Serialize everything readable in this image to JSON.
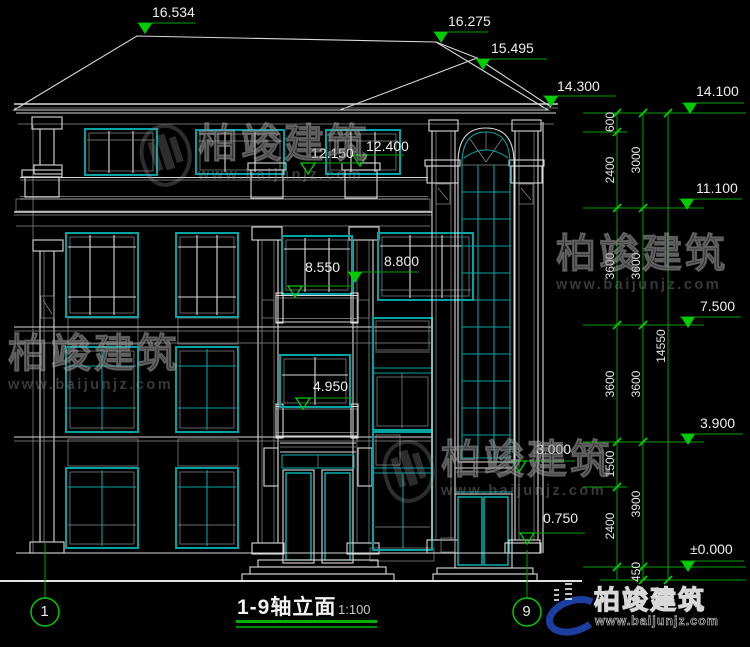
{
  "drawing_title": {
    "text": "1-9轴立面",
    "scale": "1:100"
  },
  "axes": {
    "start": "1",
    "end": "9"
  },
  "brand": {
    "name": "柏竣建筑",
    "website": "www.baijunjz.com"
  },
  "colors": {
    "dimension_green": "#00a000",
    "marker_green": "#00cc00",
    "window_teal": "#00a2a2",
    "baluster_cyan": "#00dcdc",
    "line_white": "#d9d9d9",
    "logo_blue": "#1d64d8",
    "logo_orange": "#f59e1d",
    "logo_swoosh": "#1c3e9e"
  },
  "elevation_markers": [
    {
      "value": "16.534",
      "x": 145,
      "y": 34,
      "len": 58,
      "tx": 152,
      "ty": 5,
      "solid": true
    },
    {
      "value": "16.275",
      "x": 441,
      "y": 43,
      "len": 55,
      "tx": 448,
      "ty": 14,
      "solid": true
    },
    {
      "value": "15.495",
      "x": 483,
      "y": 70,
      "len": 72,
      "tx": 491,
      "ty": 41,
      "solid": true
    },
    {
      "value": "14.300",
      "x": 551,
      "y": 107,
      "len": 73,
      "tx": 557,
      "ty": 79,
      "solid": true
    },
    {
      "value": "12.150",
      "x": 308,
      "y": 174,
      "len": 60,
      "tx": 311,
      "ty": 146,
      "solid": false
    },
    {
      "value": "12.400",
      "x": 360,
      "y": 166,
      "len": 52,
      "tx": 366,
      "ty": 139,
      "solid": false
    },
    {
      "value": "8.550",
      "x": 295,
      "y": 297,
      "len": 66,
      "tx": 305,
      "ty": 260,
      "solid": false
    },
    {
      "value": "8.800",
      "x": 355,
      "y": 283,
      "len": 72,
      "tx": 384,
      "ty": 254,
      "solid": true
    },
    {
      "value": "4.950",
      "x": 303,
      "y": 409,
      "len": 58,
      "tx": 313,
      "ty": 379,
      "solid": false
    },
    {
      "value": "3.000",
      "x": 519,
      "y": 472,
      "len": 64,
      "tx": 536,
      "ty": 442,
      "solid": false
    },
    {
      "value": "0.750",
      "x": 527,
      "y": 544,
      "len": 66,
      "tx": 543,
      "ty": 511,
      "solid": false
    },
    {
      "value": "14.100",
      "x": 690,
      "y": 114,
      "len": 62,
      "tx": 696,
      "ty": 84,
      "solid": true
    },
    {
      "value": "11.100",
      "x": 687,
      "y": 210,
      "len": 63,
      "tx": 696,
      "ty": 181,
      "solid": true
    },
    {
      "value": "7.500",
      "x": 688,
      "y": 328,
      "len": 61,
      "tx": 700,
      "ty": 299,
      "solid": true
    },
    {
      "value": "3.900",
      "x": 688,
      "y": 445,
      "len": 63,
      "tx": 700,
      "ty": 416,
      "solid": true
    },
    {
      "value": "±0.000",
      "x": 688,
      "y": 572,
      "len": 64,
      "tx": 690,
      "ty": 542,
      "solid": true
    }
  ],
  "dimensions": [
    {
      "value": "600",
      "x": 610,
      "y": 122
    },
    {
      "value": "2400",
      "x": 610,
      "y": 170
    },
    {
      "value": "3600",
      "x": 610,
      "y": 266
    },
    {
      "value": "3600",
      "x": 610,
      "y": 384
    },
    {
      "value": "1500",
      "x": 610,
      "y": 464
    },
    {
      "value": "2400",
      "x": 610,
      "y": 526
    },
    {
      "value": "3000",
      "x": 636,
      "y": 160
    },
    {
      "value": "3600",
      "x": 636,
      "y": 266
    },
    {
      "value": "3600",
      "x": 636,
      "y": 384
    },
    {
      "value": "3900",
      "x": 636,
      "y": 504
    },
    {
      "value": "450",
      "x": 636,
      "y": 572
    },
    {
      "value": "14550",
      "x": 661,
      "y": 346
    }
  ],
  "watermarks": [
    {
      "x": 140,
      "y": 124,
      "icon": true,
      "text": "柏竣建筑",
      "url": "www.baijunjz.com"
    },
    {
      "x": 8,
      "y": 334,
      "icon": false,
      "text": "柏竣建筑",
      "url": "www.baijunjz.com"
    },
    {
      "x": 556,
      "y": 234,
      "icon": false,
      "text": "柏竣建筑",
      "url": "www.baijunjz.com"
    },
    {
      "x": 383,
      "y": 440,
      "icon": true,
      "text": "柏竣建筑",
      "url": "www.baijunjz.com"
    }
  ]
}
